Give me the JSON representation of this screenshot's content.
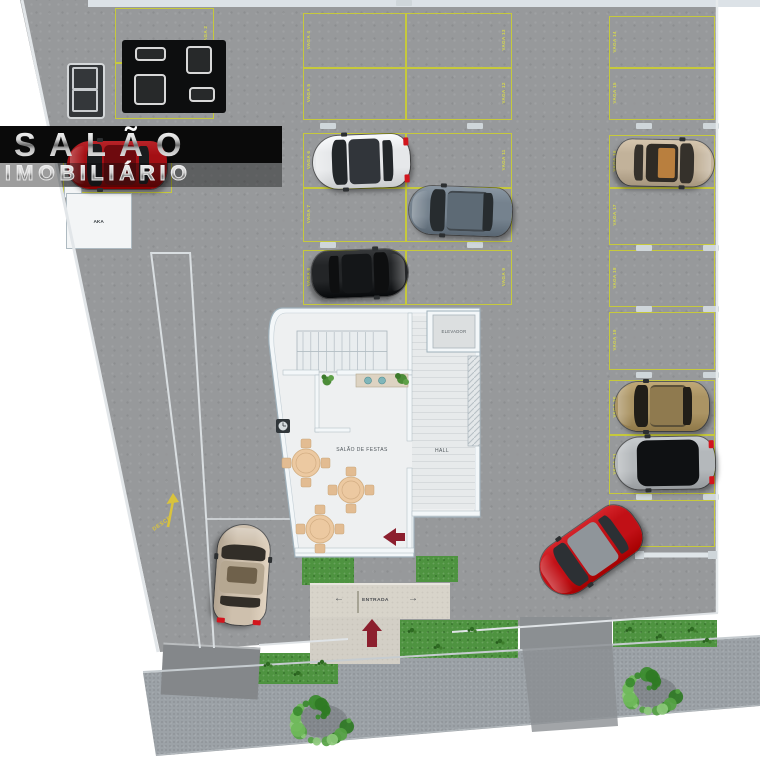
{
  "logo": {
    "line1": "SALÃO",
    "line2": "IMOBILIÁRIO"
  },
  "building": {
    "elevator": "ELEVADOR",
    "hall": "HALL",
    "salon": "SALÃO DE FESTAS"
  },
  "site": {
    "entrance": "ENTRADA",
    "ramp": "DESCE",
    "utility": "AKA",
    "arrow_left": "←",
    "arrow_right": "→"
  },
  "parking": {
    "line_color": "#c6c93c",
    "label_color": "#d6d84e",
    "spaces": [
      {
        "id": "s1",
        "label": "VAGA 1"
      },
      {
        "id": "s2",
        "label": "VAGA 2"
      },
      {
        "id": "s3",
        "label": "VAGA 3"
      },
      {
        "id": "s4",
        "label": "VAGA 4"
      },
      {
        "id": "s5",
        "label": "VAGA 5"
      },
      {
        "id": "s6",
        "label": "VAGA 6"
      },
      {
        "id": "s7",
        "label": "VAGA 7"
      },
      {
        "id": "s8",
        "label": "VAGA 8"
      },
      {
        "id": "s9",
        "label": "VAGA 9"
      },
      {
        "id": "s10",
        "label": "VAGA 10"
      },
      {
        "id": "s11",
        "label": "VAGA 11"
      },
      {
        "id": "s12",
        "label": "VAGA 12"
      },
      {
        "id": "s13",
        "label": "VAGA 13"
      },
      {
        "id": "s14",
        "label": "VAGA 14"
      },
      {
        "id": "s15",
        "label": "VAGA 15"
      },
      {
        "id": "s16",
        "label": "VAGA 16"
      },
      {
        "id": "s17",
        "label": "VAGA 17"
      },
      {
        "id": "s18",
        "label": "VAGA 18"
      },
      {
        "id": "s19",
        "label": "VAGA 19"
      },
      {
        "id": "s20",
        "label": "VAGA 20"
      },
      {
        "id": "s21",
        "label": "VAGA 21"
      },
      {
        "id": "s22",
        "label": "VAGA 22"
      }
    ]
  },
  "cars": [
    {
      "id": "car-red-logo",
      "name": "red-parked-car",
      "body": "#a30f14",
      "glass": "#1a1c1e",
      "roof": "#6e0a0e"
    },
    {
      "id": "car-white",
      "name": "white-hatchback",
      "body": "#e6e8ea",
      "glass": "#23272a",
      "roof": "#31353a"
    },
    {
      "id": "car-gray-van",
      "name": "gray-minivan",
      "body": "#75828e",
      "glass": "#272c2f",
      "roof": "#5d6a75"
    },
    {
      "id": "car-black",
      "name": "black-car",
      "body": "#232527",
      "glass": "#0e0f10",
      "roof": "#141618"
    },
    {
      "id": "car-tan-sedan",
      "name": "tan-sedan",
      "body": "#c2b29a",
      "glass": "#35312b",
      "roof": "#2f2b25"
    },
    {
      "id": "car-gold-suv",
      "name": "gold-suv",
      "body": "#ab9464",
      "glass": "#211e18",
      "roof": "#8f7a4f"
    },
    {
      "id": "car-dark-sedan",
      "name": "silver-sports-car",
      "body": "#b4b8bb",
      "glass": "#0f1113",
      "roof": "#151719"
    },
    {
      "id": "car-red-angled",
      "name": "red-car-driving",
      "body": "#c11016",
      "glass": "#2c3034",
      "roof": "#8f959a"
    },
    {
      "id": "car-beige",
      "name": "beige-car-driving",
      "body": "#cec0ad",
      "glass": "#322e28",
      "roof": "#b5a791"
    }
  ],
  "colors": {
    "lot": "#97999b",
    "sidewalk": "#9ca2a7",
    "grass": "#4e9340",
    "concrete": "#d8d4ca",
    "driveway": "#85888b",
    "arrow_red": "#8c1f2e",
    "banner": "#0a0a0a",
    "wall": "#f3f7f9",
    "floor": "#eef0f1",
    "ramp_arrow": "#d9c33c"
  }
}
